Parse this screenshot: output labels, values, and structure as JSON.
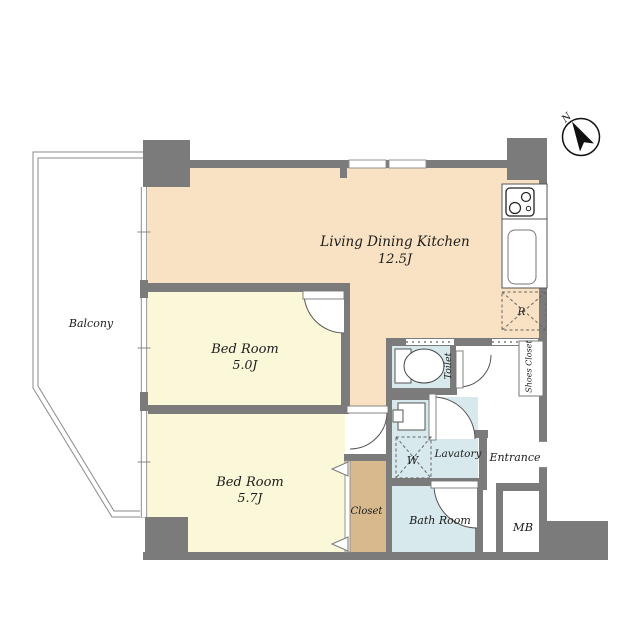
{
  "labels": {
    "ldk_name": "Living Dining Kitchen",
    "ldk_size": "12.5J",
    "bedroom1_name": "Bed Room",
    "bedroom1_size": "5.0J",
    "bedroom2_name": "Bed Room",
    "bedroom2_size": "5.7J",
    "balcony": "Balcony",
    "closet": "Closet",
    "toilet": "Toilet",
    "lavatory": "Lavatory",
    "bathroom": "Bath Room",
    "entrance": "Entrance",
    "shoes_closet": "Shoes Closet",
    "meter_box": "MB",
    "refrigerator": "R",
    "washing_machine": "W",
    "north": "N"
  },
  "colors": {
    "wall": "#7b7b7b",
    "ldk_floor": "#f9e2c3",
    "bedroom_floor": "#fbf7d9",
    "closet_floor": "#d8b98e",
    "wet_area_floor": "#d7e9ec",
    "outline": "#888888",
    "text": "#1c1c1c"
  }
}
